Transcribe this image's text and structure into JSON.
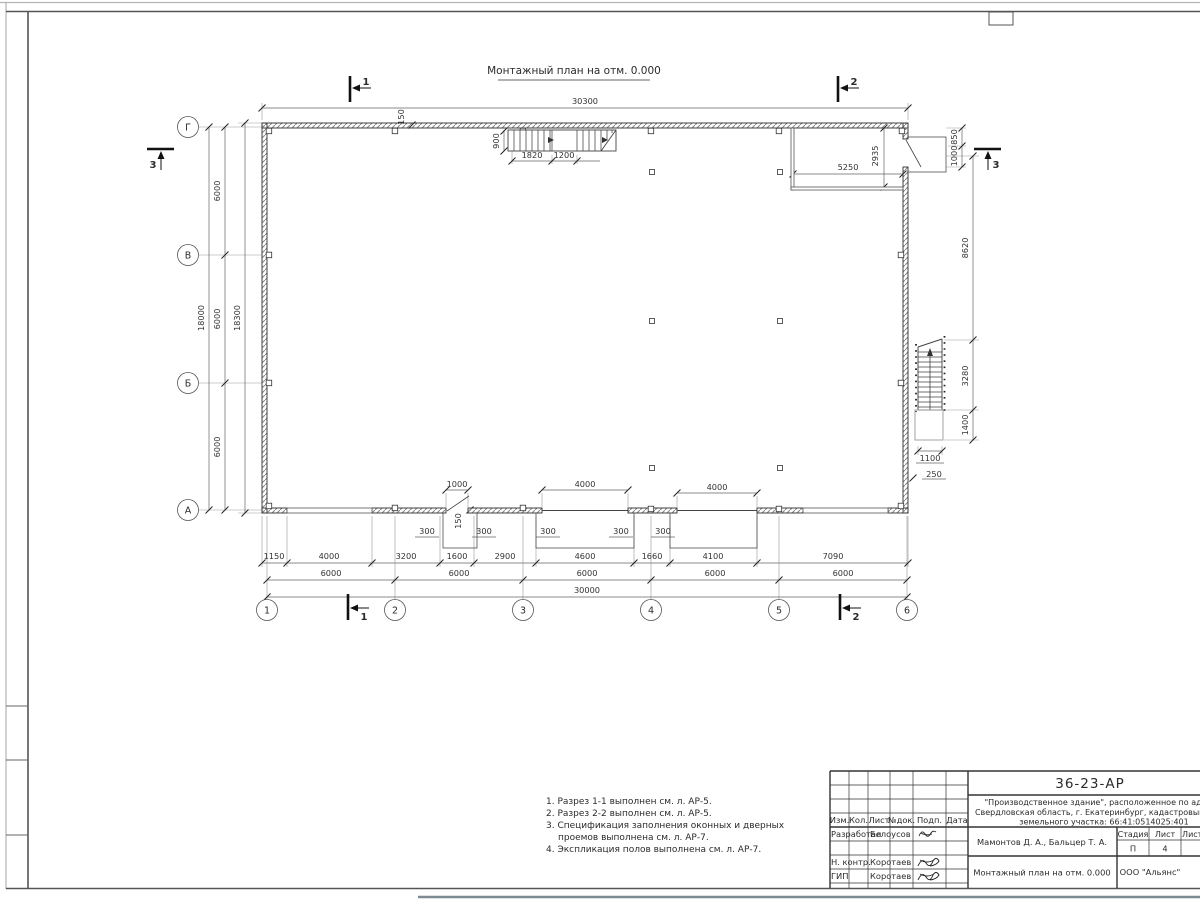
{
  "sheet": {
    "title": "Монтажный план на отм. 0.000",
    "notes": [
      "1. Разрез 1-1 выполнен см. л. АР-5.",
      "2. Разрез 2-2 выполнен см. л. АР-5.",
      "3. Спецификация заполнения оконных и дверных",
      "проемов выполнена см. л. АР-7.",
      "4. Экспликация полов выполнена см. л. АР-7."
    ]
  },
  "axes": {
    "rows": [
      "Г",
      "В",
      "Б",
      "А"
    ],
    "cols": [
      "1",
      "2",
      "3",
      "4",
      "5",
      "6"
    ]
  },
  "sections": {
    "s1": "1",
    "s2": "2",
    "s3": "3"
  },
  "dims": {
    "top_total": "30300",
    "bottom_total": "30000",
    "bottom_chain": [
      "1150",
      "4000",
      "3200",
      "1600",
      "2900",
      "4600",
      "1660",
      "4100",
      "7090"
    ],
    "axis_spacing": [
      "6000",
      "6000",
      "6000",
      "6000",
      "6000"
    ],
    "left_heights": [
      "6000",
      "6000",
      "6000"
    ],
    "left_total": "18000",
    "left_outer": "18300",
    "right_chain": [
      "8620",
      "3280",
      "1400"
    ],
    "porch": [
      "850",
      "1000"
    ],
    "ext_stair_width": "1100",
    "ext_stair_offset": "250",
    "room_width": "5250",
    "room_depth": "2935",
    "stair_width": "900",
    "stair_run1": "1820",
    "stair_run2": "1200",
    "door_width": "1000",
    "gate1_width": "4000",
    "gate2_width": "4000",
    "jamb": "300",
    "wall_thk": "150"
  },
  "titleblock": {
    "doc_number": "36-23-АР",
    "project_line1": "\"Производственное здание\", расположенное по адресу:",
    "project_line2": "Свердловская область, г. Екатеринбург, кадастровый номер",
    "project_line3": "земельного участка: 66:41:0514025:401",
    "columns": [
      "Изм.",
      "Кол.",
      "Лист",
      "№док.",
      "Подп.",
      "Дата"
    ],
    "roles": [
      {
        "role": "Разработал",
        "name": "Белоусов"
      },
      {
        "role": "Н. контр.",
        "name": "Коротаев"
      },
      {
        "role": "ГИП",
        "name": "Коротаев"
      }
    ],
    "authors": "Мамонтов Д. А., Бальцер Т. А.",
    "stage_label": "Стадия",
    "sheet_label": "Лист",
    "sheets_label": "Листов",
    "stage": "П",
    "sheet_num": "4",
    "drawing_title": "Монтажный план на отм. 0.000",
    "company": "ООО \"Альянс\""
  }
}
